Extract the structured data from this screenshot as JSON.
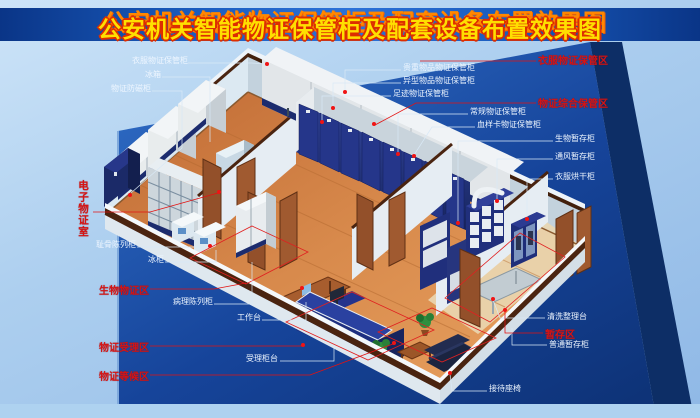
{
  "title": {
    "text": "公安机关智能物证保管柜及配套设备布置效果图"
  },
  "zones": {
    "electronic_evidence_room": "电子物证室",
    "biological_evidence": "生物物证区",
    "acceptance": "物证受理区",
    "waiting": "物证等候区",
    "clothing_storage": "衣服物证保管区",
    "comprehensive_storage": "物证综合保管区",
    "temporary_storage": "暂存区"
  },
  "equipment": {
    "clothing_cabinet": "衣服物证保管柜",
    "refrigerator": "冰箱",
    "antimagnetic_cabinet": "物证防磁柜",
    "bone_display_cabinet": "耻骨陈列柜",
    "freezer": "冰柜",
    "pathology_cabinet": "病理陈列柜",
    "workbench": "工作台",
    "reception_counter": "受理柜台",
    "valuables_cabinet": "贵重物品物证保管柜",
    "irregular_items_cabinet": "异型物品物证保管柜",
    "footprint_cabinet": "足迹物证保管柜",
    "regular_cabinet": "常规物证保管柜",
    "blood_sample_cabinet": "血样卡物证保管柜",
    "bio_temp_cabinet": "生物暂存柜",
    "ventilation_temp_cabinet": "通风暂存柜",
    "clothes_drying_cabinet": "衣服烘干柜",
    "cleaning_table": "清洗整理台",
    "ordinary_temp_cabinet": "普通暂存柜",
    "reception_seats": "接待座椅"
  },
  "colors": {
    "banner_blue": "#1a5cbe",
    "title_yellow": "#ffdf00",
    "title_red_outline": "#dd2e00",
    "zone_label_red": "#d61414",
    "equipment_label_white": "#eef6ff",
    "backdrop_blue": "#1d55ae",
    "cabinet_navy": "#24358a",
    "floor_wood": "#c97a42",
    "door_wood": "#93502a",
    "leader_dot_red": "#f01414"
  }
}
